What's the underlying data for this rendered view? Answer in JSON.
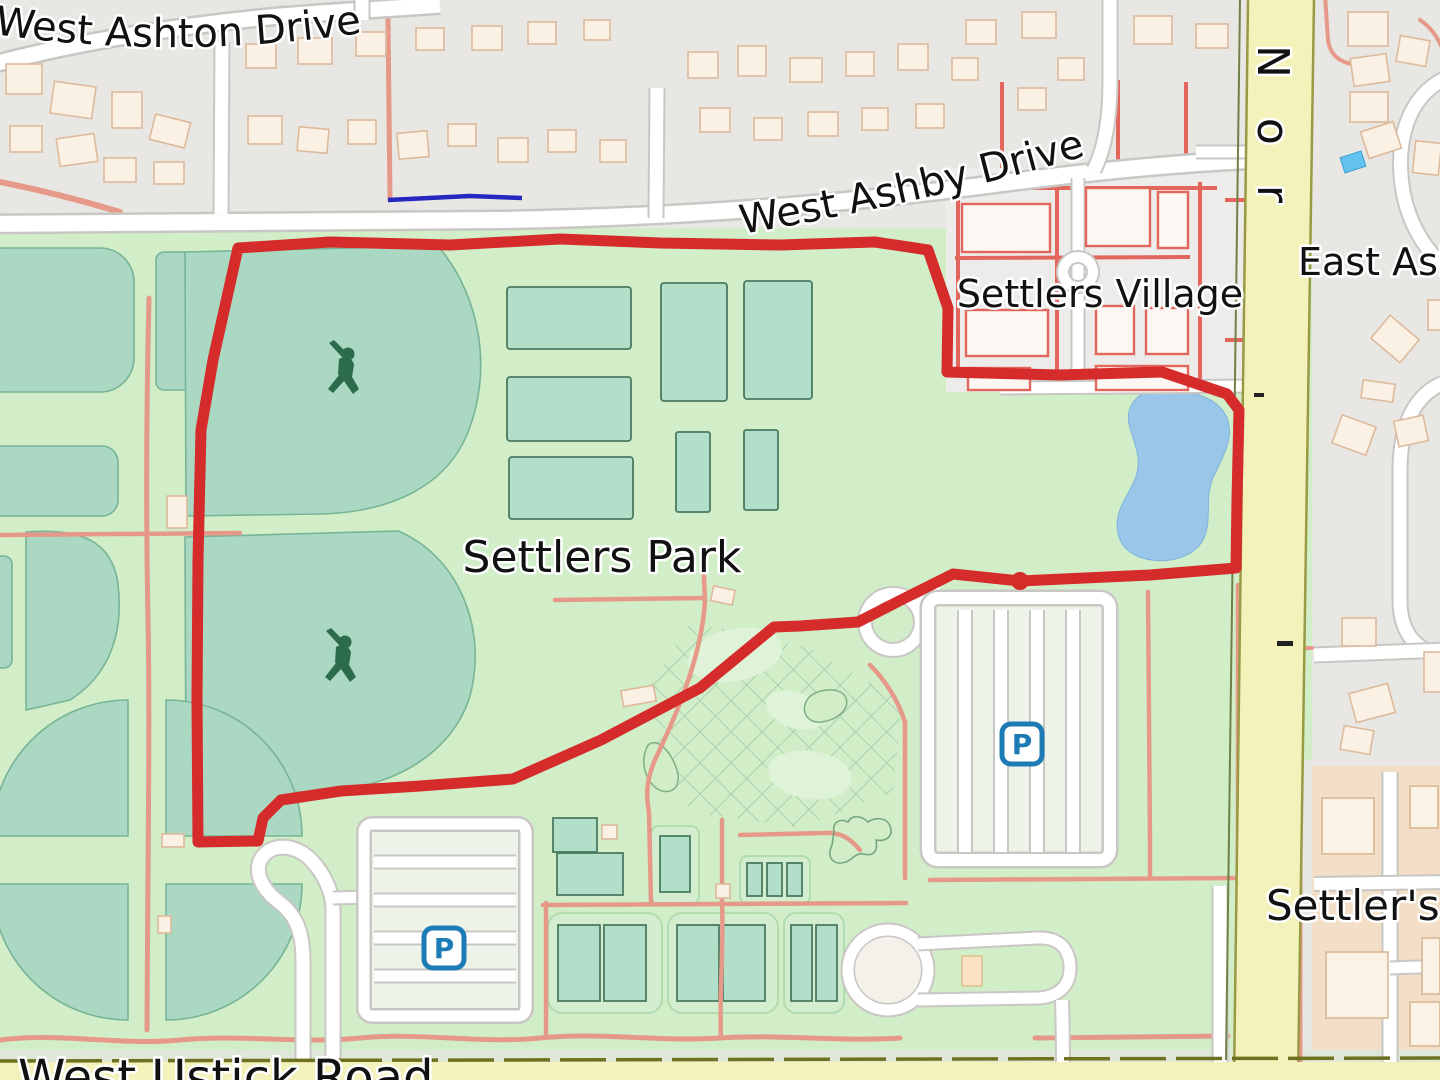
{
  "labels": {
    "west_ashton_drive": "West Ashton Drive",
    "west_ashby_drive": "West Ashby Drive",
    "east_ashby_partial": "East Ash",
    "north_road_partial": "Nor",
    "west_ustick_road": "West Ustick Road",
    "settlers_park": "Settlers Park",
    "settlers_village": "Settlers Village",
    "settlers_place_partial": "Settler's"
  },
  "icons": {
    "parking_letter": "P",
    "parking_icon_count": 2,
    "baseball_player_icon_count": 2
  },
  "route": {
    "color": "#d62b2b",
    "waypoint_dot": {
      "x": 1020,
      "y": 581
    }
  },
  "colors": {
    "park_green": "#d1eec8",
    "pitch_teal": "#aad8c2",
    "water_blue": "#9ac7e9",
    "road_yellow": "#f4f2bb",
    "residential_gray": "#e9e7e4",
    "retail_tan": "#f3dec8",
    "path_salmon": "#e69989",
    "village_red": "#e2665c",
    "parking_blue": "#1d7cb5",
    "park_label_green": "#37463a",
    "village_label_gray": "#6d6d6d",
    "place_label_maroon": "#7d3b3f"
  }
}
